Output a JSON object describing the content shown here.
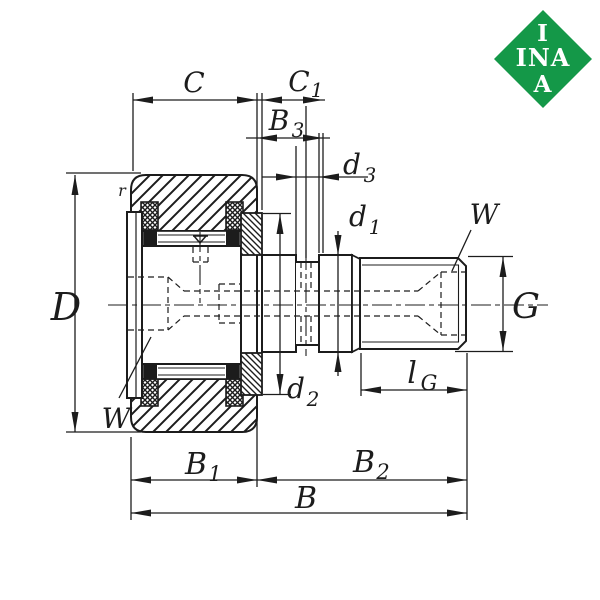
{
  "colors": {
    "ink": "#1c1c1c",
    "logo_green": "#149848",
    "background": "#ffffff"
  },
  "logo": {
    "row1": "I",
    "row2": "INA",
    "row3": "A"
  },
  "labels": {
    "C": "C",
    "C1": {
      "base": "C",
      "sub": "1"
    },
    "B3": {
      "base": "B",
      "sub": "3"
    },
    "d3": {
      "base": "d",
      "sub": "3"
    },
    "d1": {
      "base": "d",
      "sub": "1"
    },
    "d2": {
      "base": "d",
      "sub": "2"
    },
    "D": "D",
    "G": "G",
    "W_right": "W",
    "W_left": "W",
    "r": "r",
    "lG": {
      "base": "l",
      "sub": "G"
    },
    "B1": {
      "base": "B",
      "sub": "1"
    },
    "B2": {
      "base": "B",
      "sub": "2"
    },
    "B": "B"
  }
}
